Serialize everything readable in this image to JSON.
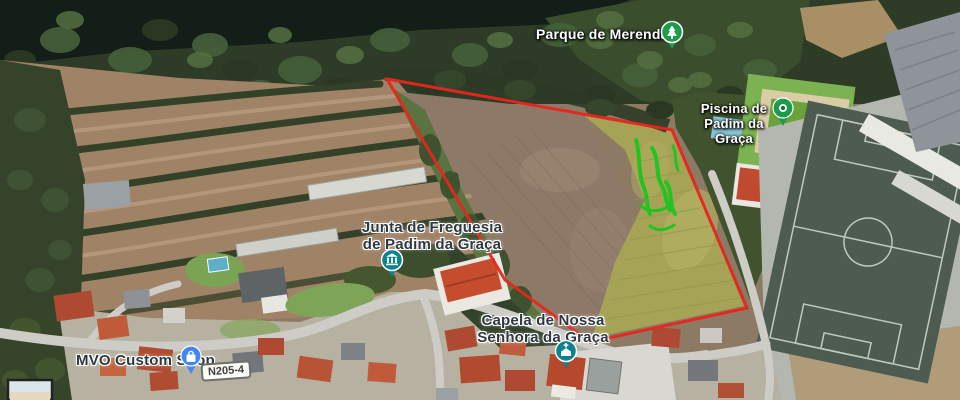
{
  "map": {
    "kind": "satellite-imagery",
    "labels": {
      "park": {
        "text": "Parque de Merendas"
      },
      "pool": {
        "line1": "Piscina de",
        "line2": "Padim da Graça"
      },
      "parish": {
        "line1": "Junta de Freguesia",
        "line2": "de Padim da Graça"
      },
      "chapel": {
        "line1": "Capela de Nossa",
        "line2": "Senhora da Graça"
      },
      "shop": {
        "text": "MVO Custom Shop"
      },
      "road": {
        "shield": "N205-4"
      }
    },
    "colors": {
      "boundary_red": "#e8251d",
      "annotation_green": "#1ec41e",
      "pin_park_green": "#1d9b4d",
      "pin_civic_teal": "#0c828f",
      "pin_shop_blue": "#4285f4"
    },
    "overlay": {
      "boundary_points": "387,79 672,130 747,308 590,342 505,280 492,258",
      "scribbles": [
        "M636,140 c5,16 1,30 8,48 c4,10 2,18 6,26",
        "M652,148 c8,12 3,26 10,38 c5,9 3,16 8,24",
        "M666,182 c7,9 2,20 9,32",
        "M641,206 c9,7 19,5 27,1",
        "M650,226 c8,6 17,4 24,-1",
        "M673,146 c4,8 1,16 5,24"
      ]
    }
  }
}
